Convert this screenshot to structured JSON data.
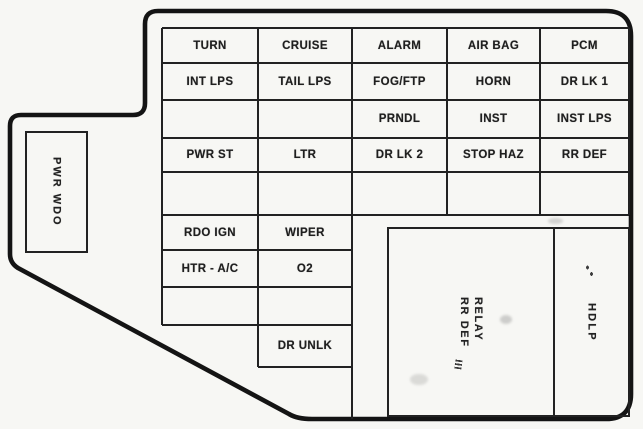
{
  "colors": {
    "background": "#f7f7f4",
    "outline": "#141414",
    "grid_line": "#222222",
    "text": "#1f1f1f"
  },
  "side_box": {
    "label": "PWR WDO"
  },
  "fuse_grid": {
    "left_columns": [
      {
        "cells": [
          "TURN",
          "INT LPS",
          "",
          "PWR ST",
          "",
          "RDO IGN",
          "HTR - A/C",
          ""
        ]
      },
      {
        "cells": [
          "CRUISE",
          "TAIL LPS",
          "",
          "LTR",
          "",
          "WIPER",
          "O2",
          "",
          "DR UNLK"
        ]
      }
    ],
    "right_columns": [
      {
        "cells": [
          "ALARM",
          "FOG/FTP",
          "PRNDL",
          "DR LK 2",
          ""
        ]
      },
      {
        "cells": [
          "AIR BAG",
          "HORN",
          "INST",
          "STOP HAZ",
          ""
        ]
      },
      {
        "cells": [
          "PCM",
          "DR LK 1",
          "INST LPS",
          "RR DEF",
          ""
        ]
      }
    ]
  },
  "relay_section": {
    "relay_line1": "RELAY",
    "relay_line2": "RR DEF",
    "hdlp_label": "HDLP"
  }
}
